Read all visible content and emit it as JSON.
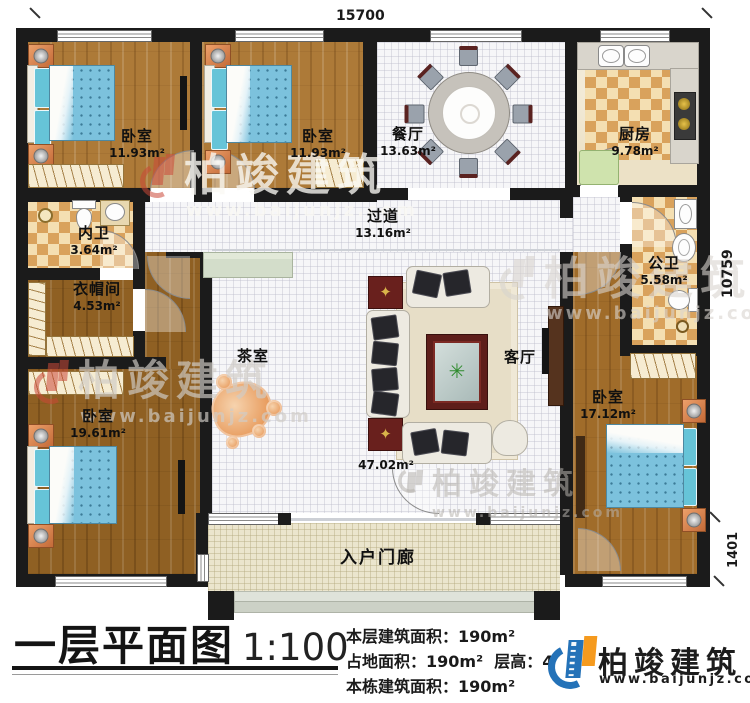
{
  "plan": {
    "dim_top": "15700",
    "dim_right_upper": "10759",
    "dim_right_lower": "1401",
    "rooms": {
      "bedroom_tl": {
        "name": "卧室",
        "area": "11.93m²"
      },
      "bedroom_tm": {
        "name": "卧室",
        "area": "11.93m²"
      },
      "dining": {
        "name": "餐厅",
        "area": "13.63m²"
      },
      "kitchen": {
        "name": "厨房",
        "area": "9.78m²"
      },
      "inner_bath": {
        "name": "内卫",
        "area": "3.64m²"
      },
      "corridor": {
        "name": "过道",
        "area": "13.16m²"
      },
      "cloakroom": {
        "name": "衣帽间",
        "area": "4.53m²"
      },
      "public_bath": {
        "name": "公卫",
        "area": "5.58m²"
      },
      "tea_room": {
        "name": "茶室",
        "area": ""
      },
      "living": {
        "name": "客厅",
        "area": "47.02m²"
      },
      "bedroom_bl": {
        "name": "卧室",
        "area": "19.61m²"
      },
      "bedroom_br": {
        "name": "卧室",
        "area": "17.12m²"
      },
      "porch": {
        "name": "入户门廊",
        "area": ""
      }
    }
  },
  "watermark": {
    "brand": "柏竣建筑",
    "site": "www.baijunjz.com"
  },
  "footer": {
    "title": "一层平面图",
    "scale": "1:100",
    "stat1_label": "本层建筑面积：",
    "stat1_value": "190m²",
    "stat2_label": "占地面积：",
    "stat2_value": "190m²",
    "stat2b_label": "层高：",
    "stat2b_value": "4",
    "stat3_label": "本栋建筑面积：",
    "stat3_value": "190m²",
    "brand": "柏竣建筑",
    "site": "www.baijunjz.com"
  },
  "colors": {
    "wall": "#1b1b1b",
    "accent_blue": "#2472b8",
    "accent_orange": "#f59a1e",
    "bed_blue": "#7cc2dd",
    "checker_tan": "#d9a25c"
  }
}
